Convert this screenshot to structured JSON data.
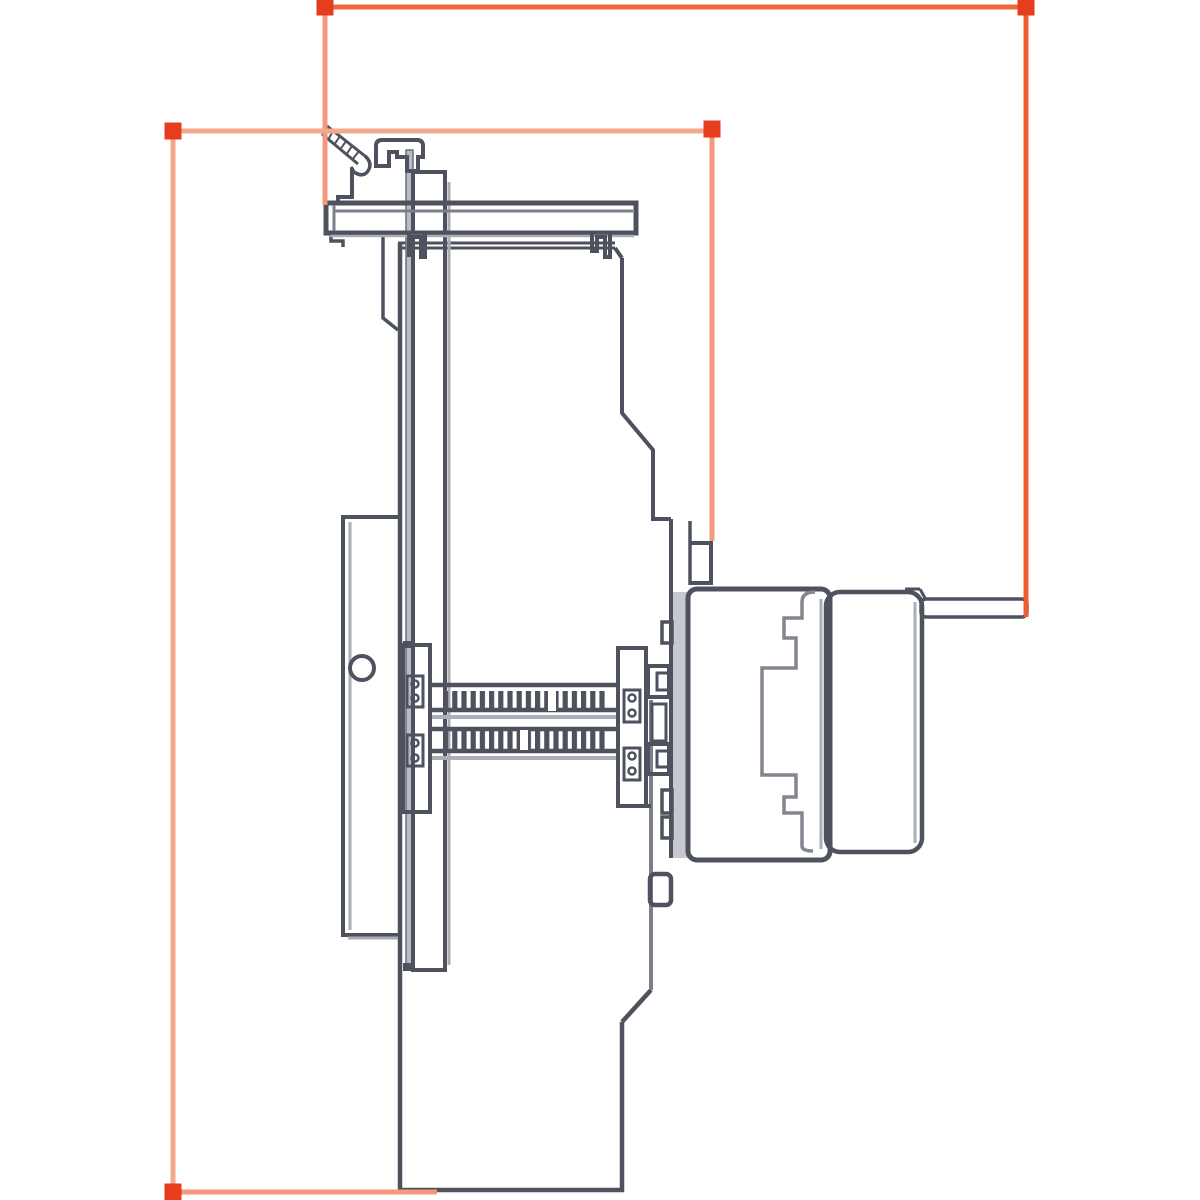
{
  "canvas": {
    "width": 1200,
    "height": 1200,
    "background": "#ffffff"
  },
  "annotation": {
    "marker_color": "#e63e1c",
    "marker_size": 17,
    "line_width": 5,
    "markers": [
      {
        "id": "handle-top-left",
        "x": 325,
        "y": 7
      },
      {
        "id": "handle-top-right",
        "x": 1026,
        "y": 7
      },
      {
        "id": "handle-mid-left",
        "x": 173,
        "y": 131
      },
      {
        "id": "handle-mid-right",
        "x": 712,
        "y": 129
      },
      {
        "id": "handle-bottom-left",
        "x": 173,
        "y": 1192
      }
    ],
    "lines": [
      {
        "id": "dim-line-top",
        "x1": 325,
        "y1": 7,
        "x2": 1026,
        "y2": 7,
        "color": "#ee6a3e"
      },
      {
        "id": "dim-line-right",
        "x1": 1026,
        "y1": 7,
        "x2": 1026,
        "y2": 617,
        "color": "#ee5c34"
      },
      {
        "id": "dim-drop-bracket",
        "x1": 325,
        "y1": 7,
        "x2": 325,
        "y2": 205,
        "color": "#f4997b"
      },
      {
        "id": "dim-line-mid",
        "x1": 173,
        "y1": 131,
        "x2": 712,
        "y2": 131,
        "color": "#f6a88d"
      },
      {
        "id": "dim-drop-flange",
        "x1": 712,
        "y1": 131,
        "x2": 712,
        "y2": 541,
        "color": "#f4997b"
      },
      {
        "id": "dim-line-left",
        "x1": 173,
        "y1": 131,
        "x2": 173,
        "y2": 1192,
        "color": "#f6a88d"
      },
      {
        "id": "dim-line-bottom",
        "x1": 173,
        "y1": 1192,
        "x2": 437,
        "y2": 1192,
        "color": "#f4997b"
      }
    ]
  },
  "drawing": {
    "stroke_dark": "#4d525e",
    "stroke_medium": "#7b7f89",
    "stroke_light": "#abaeb6",
    "fill_band": "#b9bcc3",
    "fill_flange": "#c7c9ce",
    "fill_tab": "#d9dadd",
    "parts": [
      "mounting-hook",
      "latch-knob",
      "mounting-bar",
      "bar-clips",
      "back-plate",
      "side-plate",
      "pivot-hole",
      "lead-screw-upper",
      "lead-screw-lower",
      "bearing-block-left",
      "bearing-block-right",
      "coupling-clips",
      "motor-flange",
      "flange-step",
      "gearbox-housing",
      "gear-profile",
      "motor-can",
      "terminal-tab",
      "sensor-boss",
      "housing-body"
    ]
  }
}
